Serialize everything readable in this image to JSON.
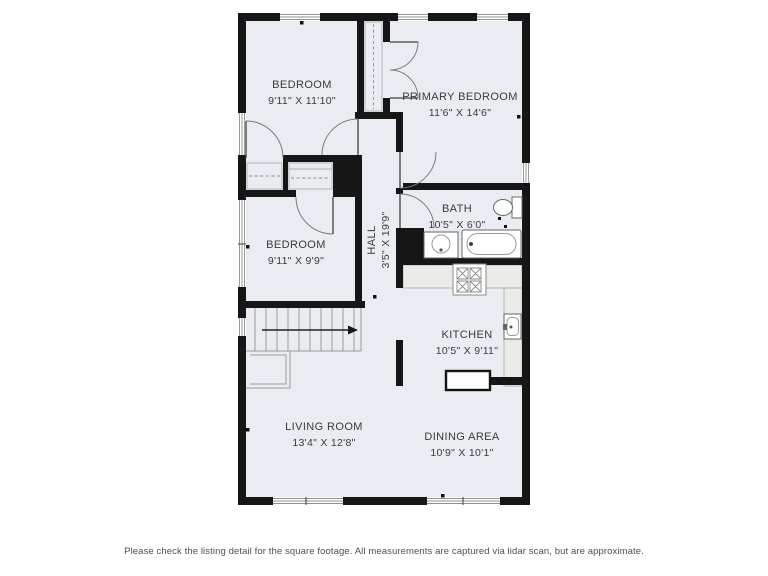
{
  "page": {
    "disclaimer": "Please check the listing detail for the square footage. All measurements are captured via lidar scan, but are approximate."
  },
  "palette": {
    "wall": "#161616",
    "floor": "#e9edf1",
    "counter": "#ebebe8",
    "fixture_line": "#666666",
    "window_line": "#8f8f8f",
    "label_text": "#3a3a3a"
  },
  "rooms": [
    {
      "id": "bedroom-top",
      "name": "BEDROOM",
      "dims": "9'11\" X 11'10\""
    },
    {
      "id": "primary-bedroom",
      "name": "PRIMARY BEDROOM",
      "dims": "11'6\" X 14'6\""
    },
    {
      "id": "bedroom-mid",
      "name": "BEDROOM",
      "dims": "9'11\" X 9'9\""
    },
    {
      "id": "hall",
      "name": "HALL",
      "dims": "3'5\" X 19'9\""
    },
    {
      "id": "bath",
      "name": "BATH",
      "dims": "10'5\" X 6'0\""
    },
    {
      "id": "kitchen",
      "name": "KITCHEN",
      "dims": "10'5\" X 9'11\""
    },
    {
      "id": "living-room",
      "name": "LIVING ROOM",
      "dims": "13'4\" X 12'8\""
    },
    {
      "id": "dining-area",
      "name": "DINING AREA",
      "dims": "10'9\" X 10'1\""
    }
  ],
  "fixtures": [
    "stairs-up",
    "toilet",
    "vanity-sink",
    "bathtub",
    "stove",
    "kitchen-sink",
    "closet-rod",
    "double-closet-doors",
    "peninsula-counter"
  ]
}
